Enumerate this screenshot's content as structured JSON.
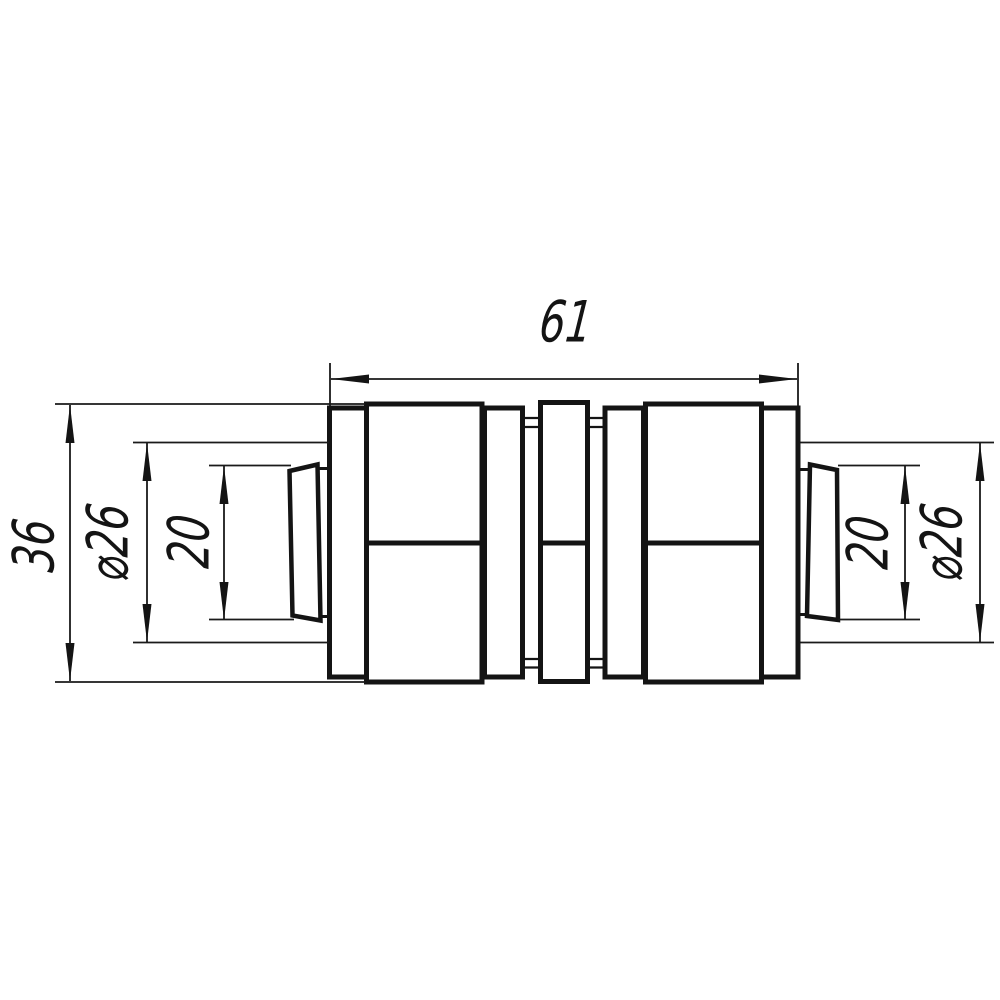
{
  "drawing": {
    "title": "pipe coupling technical drawing",
    "colors": {
      "paper": "#ffffff",
      "ink": "#141414"
    },
    "dimensions": {
      "overall_length": "61",
      "body_height": "36",
      "left_outer_diameter": "⌀26",
      "left_bore": "20",
      "right_bore": "20",
      "right_outer_diameter": "⌀26"
    }
  }
}
